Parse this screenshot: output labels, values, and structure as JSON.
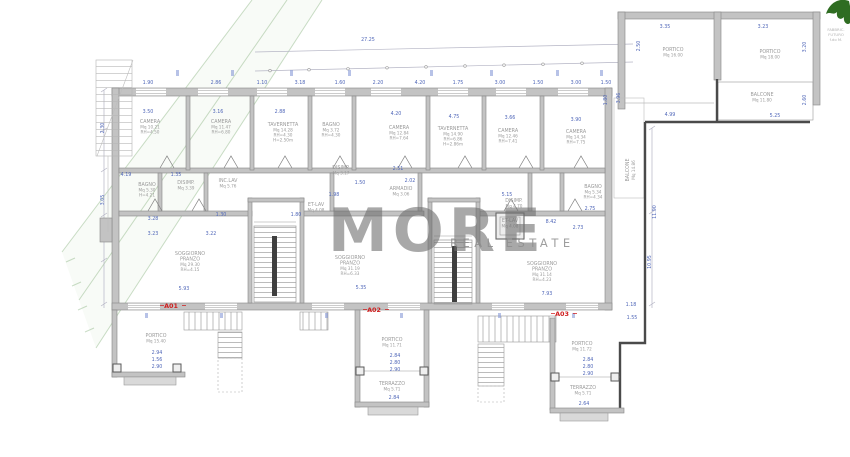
{
  "watermark": {
    "brand": "MORE",
    "tagline": "REAL ESTATE"
  },
  "site": {
    "overall_width": "27.25",
    "corner_note": [
      "FABBRIC.",
      "FUTURO",
      "f.do M."
    ]
  },
  "units": [
    {
      "tag": "A01"
    },
    {
      "tag": "A02"
    },
    {
      "tag": "A03"
    }
  ],
  "rooms": [
    {
      "n": "CAMERA",
      "a": "Mq 10.21",
      "h1": "RH=4.50"
    },
    {
      "n": "CAMERA",
      "a": "Mq 11.47",
      "h1": "RH=6.80"
    },
    {
      "n": "TAVERNETTA",
      "a": "Mq 14.28",
      "h1": "RH=4.30",
      "h2": "H=2.50m"
    },
    {
      "n": "BAGNO",
      "a": "Mq 3.72",
      "h1": "RH=4.30"
    },
    {
      "n": "CAMERA",
      "a": "Mq 12.84",
      "h1": "RH=7.64"
    },
    {
      "n": "TAVERNETTA",
      "a": "Mq 14.90",
      "h1": "RH=6.86",
      "h2": "H=2.86m"
    },
    {
      "n": "CAMERA",
      "a": "Mq 12.46",
      "h1": "RH=7.41"
    },
    {
      "n": "CAMERA",
      "a": "Mq 14.34",
      "h1": "RH=7.75"
    },
    {
      "n": "BAGNO",
      "a": "Mq 5.30",
      "h1": "H=4.21"
    },
    {
      "n": "DISIMP.",
      "a": "Mq 3.39"
    },
    {
      "n": "INC.LAV",
      "a": "Mq 5.76"
    },
    {
      "n": "DISIMP.",
      "a": "Mq 3.17"
    },
    {
      "n": "ET-LAV",
      "a": "Mq 4.08"
    },
    {
      "n": "ARMADIO",
      "a": "Mq 3.06"
    },
    {
      "n": "DISIMP.",
      "a": "Mq 4.70"
    },
    {
      "n": "ET-LAV",
      "a": "Mq 4.08"
    },
    {
      "n": "BAGNO",
      "a": "Mq 5.34",
      "h1": "RH=4.34"
    },
    {
      "n": "SOGGIORNO",
      "n2": "PRANZO",
      "a": "Mq 29.30",
      "h1": "RH=4.15"
    },
    {
      "n": "SOGGIORNO",
      "n2": "PRANZO",
      "a": "Mq 31.19",
      "h1": "RH=6.33"
    },
    {
      "n": "SOGGIORNO",
      "n2": "PRANZO",
      "a": "Mq 31.14",
      "h1": "RH=4.23"
    },
    {
      "n": "PORTICO",
      "a": "Mq 15.40"
    },
    {
      "n": "PORTICO",
      "a": "Mq 11.71"
    },
    {
      "n": "TERRAZZO",
      "a": "Mq 5.71"
    },
    {
      "n": "PORTICO",
      "a": "Mq 11.72"
    },
    {
      "n": "TERRAZZO",
      "a": "Mq 5.71"
    },
    {
      "n": "PORTICO",
      "a": "Mq 16.00"
    },
    {
      "n": "PORTICO",
      "a": "Mq 18.00"
    },
    {
      "n": "BALCONE",
      "a": "Mq 11.80"
    },
    {
      "n": "BALCONE",
      "a": "Mq 14.86"
    }
  ],
  "dims": [
    "27.25",
    "1.90",
    "2.86",
    "1.10",
    "3.18",
    "1.60",
    "2.20",
    "4.20",
    "1.75",
    "3.00",
    "1.50",
    "3.00",
    "1.50",
    "3.50",
    "3.16",
    "2.88",
    "4.20",
    "4.75",
    "3.66",
    "3.90",
    "4.19",
    "1.35",
    "3.28",
    "1.30",
    "1.80",
    "1.50",
    "2.02",
    "3.23",
    "3.22",
    "5.93",
    "5.35",
    "8.42",
    "2.73",
    "2.75",
    "7.93",
    "2.94",
    "1.56",
    "2.90",
    "2.84",
    "2.80",
    "2.90",
    "2.84",
    "2.84",
    "2.80",
    "2.90",
    "2.64",
    "3.35",
    "3.23",
    "2.50",
    "3.20",
    "3.96",
    "1.80",
    "2.60",
    "4.99",
    "5.25",
    "11.90",
    "10.95",
    "1.18",
    "1.55",
    "2.30",
    "3.05",
    "5.15",
    "2.51",
    "1.98"
  ],
  "colors": {
    "dimension": "#4f66b8",
    "room_label": "#9b9b9b",
    "unit_tag": "#cf1f1f",
    "wall": "#c3c3c3",
    "boundary": "#4a4a4a",
    "greenery": "#2f6d22"
  }
}
